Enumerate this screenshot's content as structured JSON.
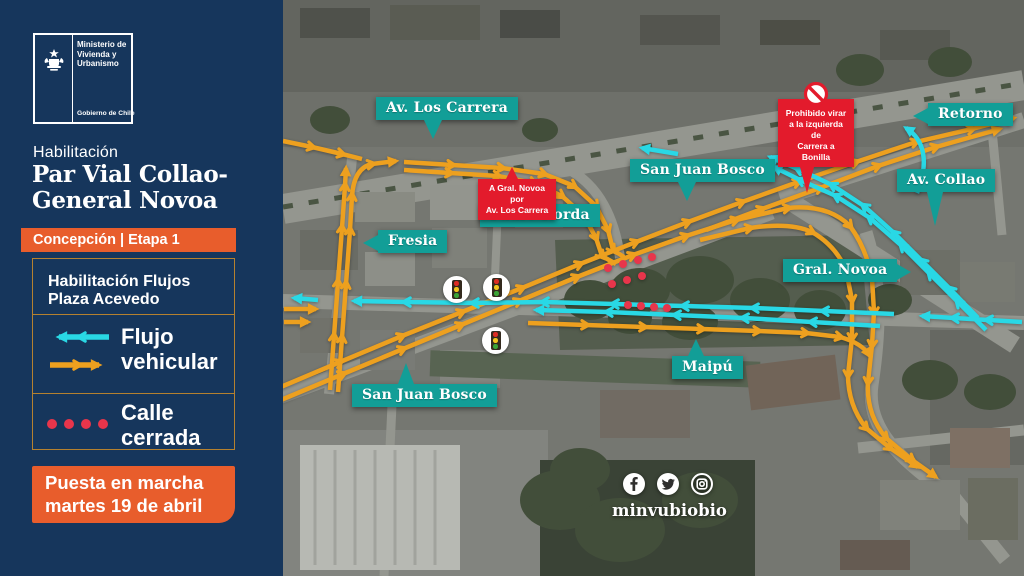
{
  "colors": {
    "sidebar_navy": "#16365c",
    "accent_orange": "#e85d2c",
    "flow_orange": "#eda01f",
    "flow_cyan": "#29d8e5",
    "closed_red": "#e8354b",
    "label_teal": "#129e97",
    "warning_red": "#e31b2c",
    "legend_border": "#b5812f"
  },
  "sidebar": {
    "logo": {
      "ministry_lines": [
        "Ministerio de",
        "Vivienda y",
        "Urbanismo"
      ],
      "government": "Gobierno de Chile"
    },
    "kicker": "Habilitación",
    "title_lines": [
      "Par Vial Collao-",
      "General Novoa"
    ],
    "badge": "Concepción | Etapa 1",
    "legend": {
      "heading_lines": [
        "Habilitación Flujos",
        "Plaza Acevedo"
      ],
      "flow_lines": [
        "Flujo",
        "vehicular"
      ],
      "closed_lines": [
        "Calle",
        "cerrada"
      ]
    },
    "launch_lines": [
      "Puesta en marcha",
      "martes 19 de abril"
    ]
  },
  "map": {
    "street_labels": [
      {
        "id": "av-los-carrera",
        "text": "Av. Los Carrera"
      },
      {
        "id": "san-juan-bosco-top",
        "text": "San Juan Bosco"
      },
      {
        "id": "retorno",
        "text": "Retorno"
      },
      {
        "id": "av-collao",
        "text": "Av. Collao"
      },
      {
        "id": "padre-korda",
        "text": "Padre Korda"
      },
      {
        "id": "fresia",
        "text": "Fresia"
      },
      {
        "id": "gral-novoa",
        "text": "Gral. Novoa"
      },
      {
        "id": "maipu",
        "text": "Maipú"
      },
      {
        "id": "san-juan-bosco-bottom",
        "text": "San Juan Bosco"
      }
    ],
    "warnings": [
      {
        "lines": [
          "A Gral. Novoa por",
          "Av. Los Carrera"
        ]
      },
      {
        "lines": [
          "Prohibido virar",
          "a la izquierda de",
          "Carrera a Bonilla"
        ]
      }
    ],
    "traffic_light_count": "3",
    "social": {
      "handle": "minvubiobio",
      "icons": [
        "facebook",
        "twitter",
        "instagram"
      ]
    }
  }
}
